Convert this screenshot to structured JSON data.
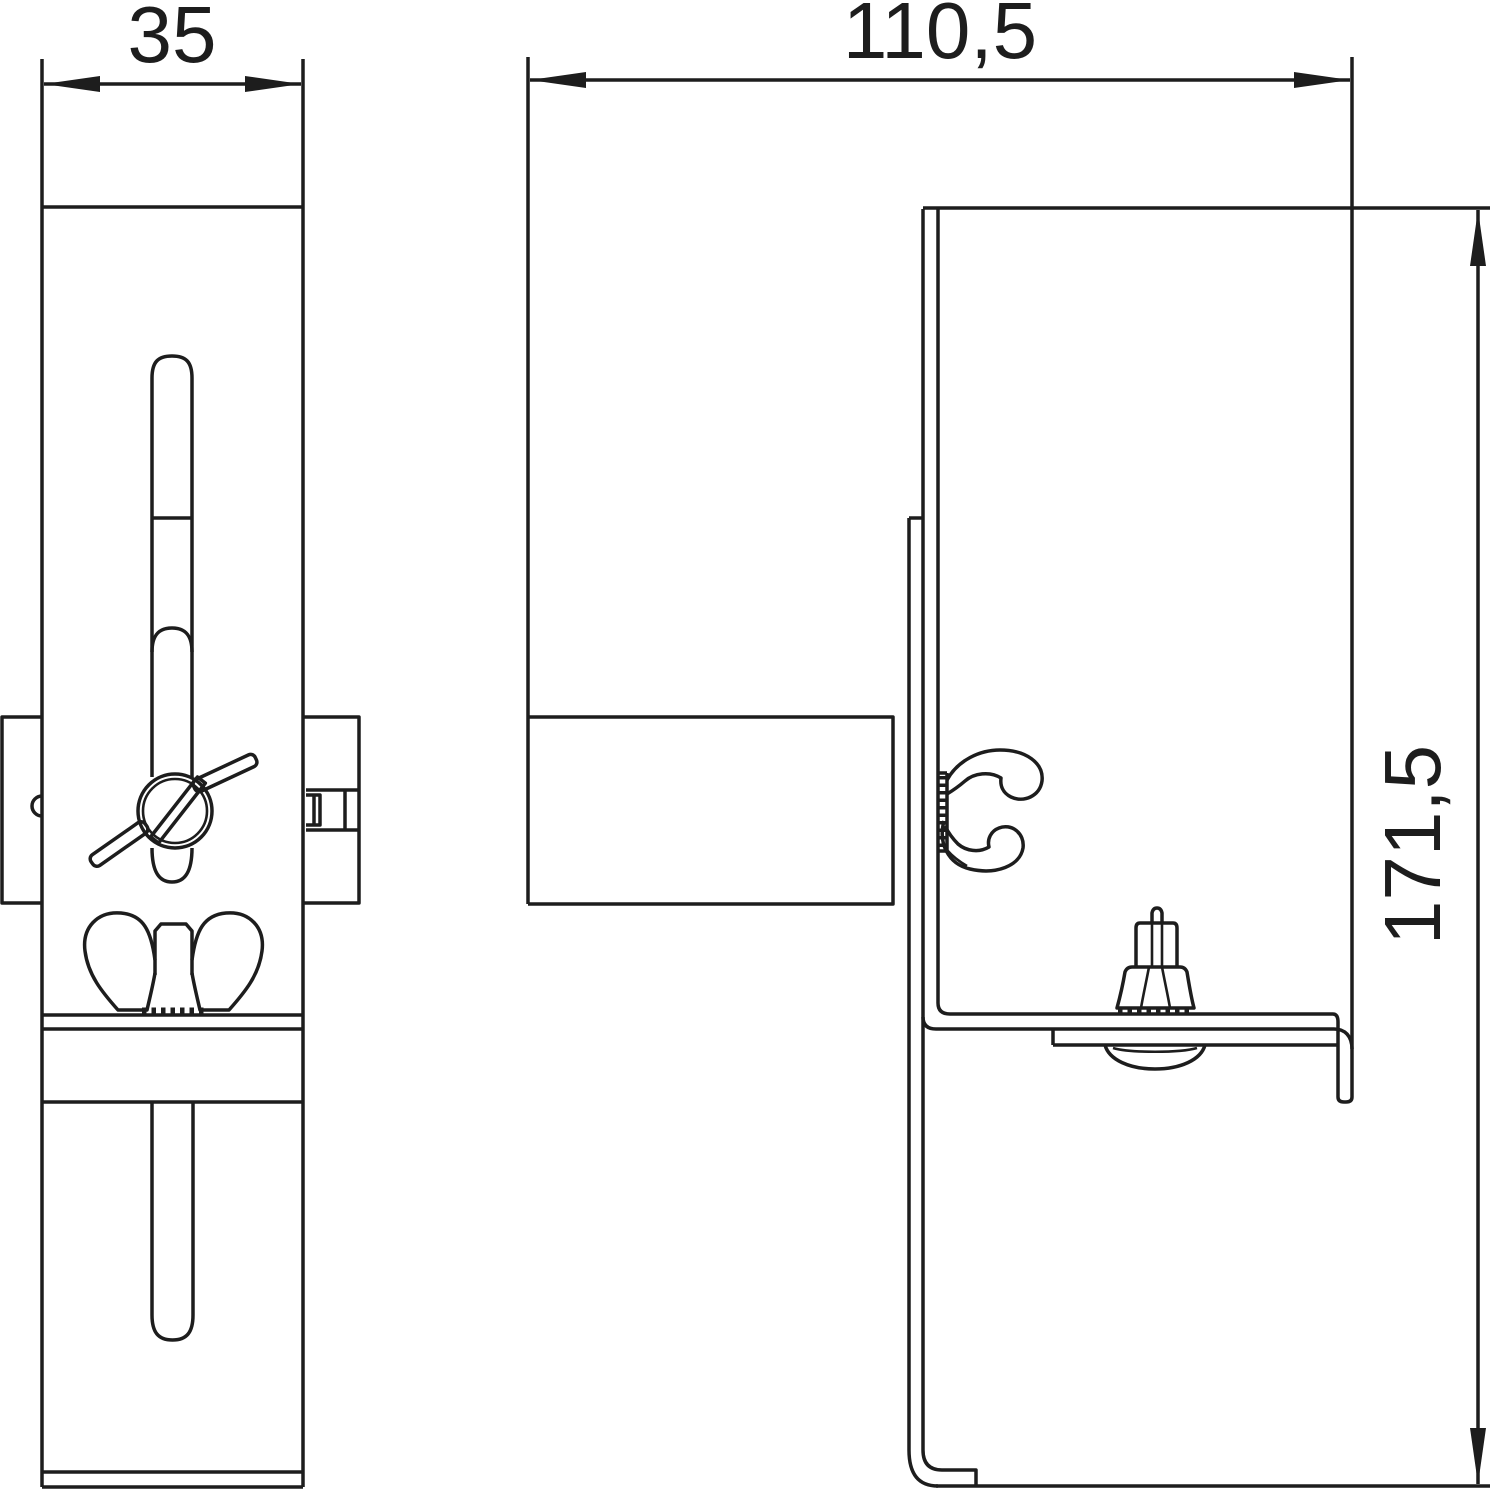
{
  "drawing": {
    "kind": "technical-drawing-two-views",
    "background_color": "#ffffff",
    "line_color": "#1d1d1d",
    "dimensions": {
      "front_width": "35",
      "side_width": "110,5",
      "side_height": "171,5"
    }
  }
}
